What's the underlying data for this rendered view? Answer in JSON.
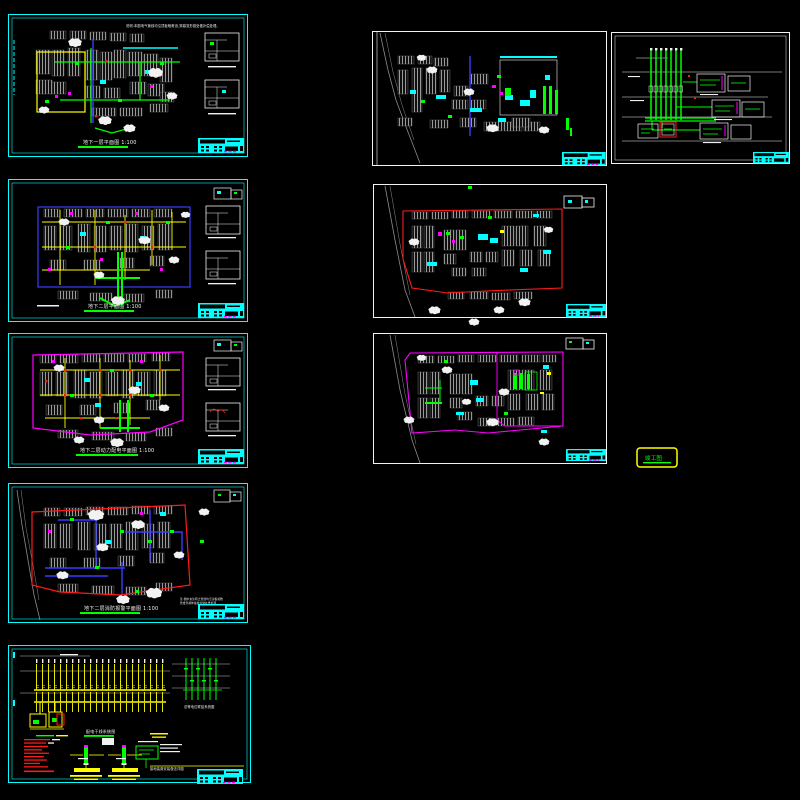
{
  "canvas": {
    "width": 800,
    "height": 800,
    "background": "#000000"
  },
  "palette": {
    "bg": "#000000",
    "cyan": "#00ffff",
    "white": "#f2f2f2",
    "gray": "#8c8c8c",
    "dgray": "#5a5a5a",
    "green": "#00ff00",
    "yellow": "#ffff00",
    "magenta": "#ff00ff",
    "red": "#ff1a1a",
    "blue": "#3b3bff"
  },
  "sheets": {
    "l1": {
      "caption": "地下一层平面图 1:100",
      "top_note": "说明:本图电气管线均沿顶板暗敷设,穿越变形缝处做补偿处理。"
    },
    "l2": {
      "caption": "地下二层平面图 1:100"
    },
    "l3": {
      "caption": "地下二层动力配电平面图 1:100"
    },
    "l4": {
      "caption": "地下二层消防报警平面图 1:100",
      "note1": "注:图中未注明之管线均沿顶板暗敷",
      "note2": "管线穿越伸缩缝处做补偿处理"
    },
    "l5": {
      "caption_system": "配电干线系统图",
      "caption_equip": "总等电位联结系统图",
      "caption_bottom": "接地装置安装做法详图"
    },
    "stamp": {
      "text": "竣工图"
    }
  }
}
